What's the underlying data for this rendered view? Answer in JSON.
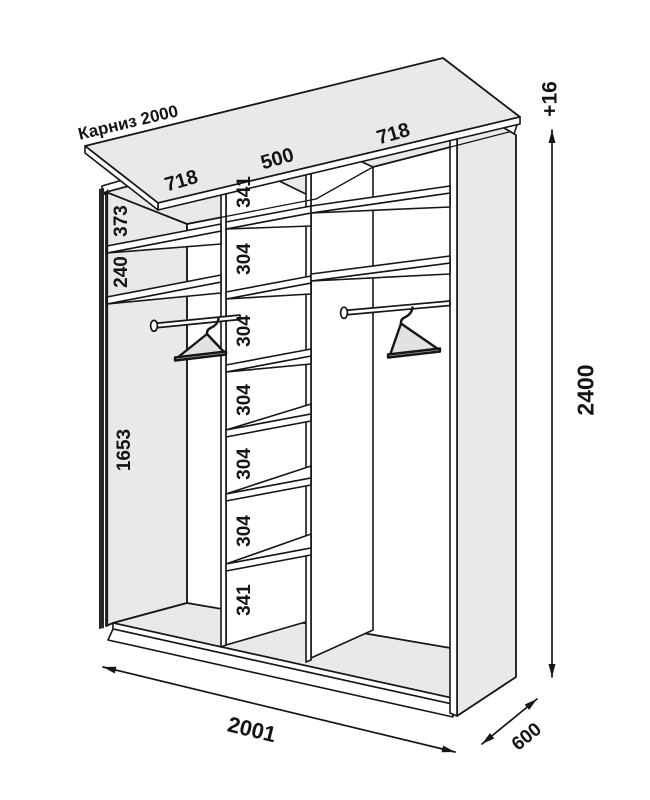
{
  "cornice": {
    "label": "Карниз 2000"
  },
  "sections": {
    "top_widths": [
      "718",
      "500",
      "718"
    ]
  },
  "left_section": {
    "cell_heights": [
      "373",
      "240",
      "1653"
    ]
  },
  "middle_section": {
    "cell_heights": [
      "341",
      "304",
      "304",
      "304",
      "304",
      "304",
      "341"
    ]
  },
  "dimensions": {
    "height": "2400",
    "height_extra": "+16",
    "width": "2001",
    "depth": "600"
  },
  "colors": {
    "panel_fill": "#e9e9e9",
    "line": "#161616",
    "background": "#ffffff"
  }
}
